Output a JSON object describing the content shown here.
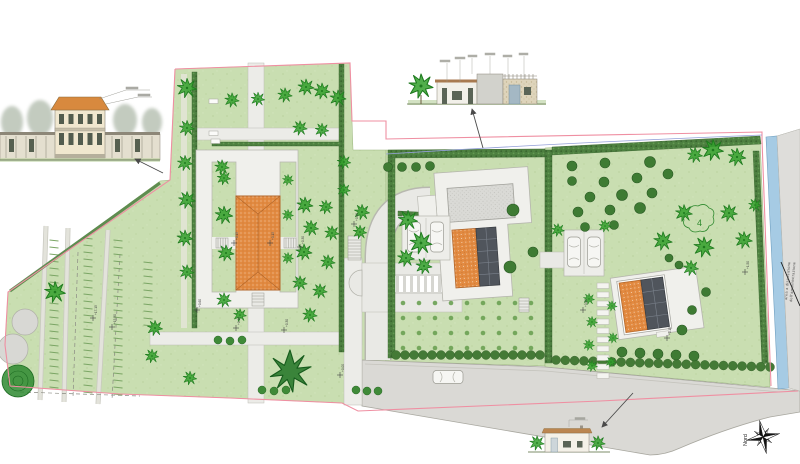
{
  "compass": {
    "north_label": "Nord"
  },
  "annotations": {
    "tree_count_label": "4",
    "road_note_line1": "area a disposizione",
    "road_note_line2": "dell'amministrazione"
  },
  "colors": {
    "lawn": "#c9deb1",
    "hedge": "#4d8040",
    "roof_orange": "#e28a41",
    "solar_panel": "#50555c",
    "canal_blue": "#a6cbe4",
    "boundary_pink": "#ef8fa2",
    "road_gray": "#dad9d5",
    "tree_green": "#33a02c"
  },
  "elevation_markers": [
    {
      "x": 93,
      "y": 318,
      "label": "+17.15"
    },
    {
      "x": 112,
      "y": 327,
      "label": "+15.50"
    },
    {
      "x": 234,
      "y": 243,
      "label": "+0.15"
    },
    {
      "x": 270,
      "y": 243,
      "label": "+0.15"
    },
    {
      "x": 300,
      "y": 247,
      "label": "+0.30"
    },
    {
      "x": 354,
      "y": 224,
      "label": "+0.45"
    },
    {
      "x": 197,
      "y": 310,
      "label": "+0.60"
    },
    {
      "x": 236,
      "y": 328,
      "label": "+0.15"
    },
    {
      "x": 284,
      "y": 330,
      "label": "+0.30"
    },
    {
      "x": 340,
      "y": 375,
      "label": "+0.00"
    },
    {
      "x": 583,
      "y": 310,
      "label": "+0.00"
    },
    {
      "x": 667,
      "y": 338,
      "label": "+0.15"
    },
    {
      "x": 745,
      "y": 272,
      "label": "+1.50"
    }
  ],
  "plan": {
    "trees_bright": [
      [
        187,
        88,
        1.2
      ],
      [
        232,
        100,
        0.9
      ],
      [
        258,
        99,
        0.85
      ],
      [
        285,
        95,
        0.9
      ],
      [
        306,
        87,
        1.0
      ],
      [
        322,
        91,
        1.0
      ],
      [
        338,
        98,
        1.0
      ],
      [
        300,
        128,
        0.9
      ],
      [
        322,
        130,
        0.85
      ],
      [
        187,
        128,
        0.95
      ],
      [
        185,
        163,
        0.95
      ],
      [
        187,
        200,
        1.05
      ],
      [
        185,
        238,
        1.0
      ],
      [
        187,
        272,
        0.9
      ],
      [
        222,
        167,
        0.9
      ],
      [
        224,
        178,
        0.85
      ],
      [
        224,
        215,
        1.1
      ],
      [
        226,
        253,
        1.0
      ],
      [
        224,
        300,
        0.9
      ],
      [
        288,
        180,
        0.7
      ],
      [
        288,
        215,
        0.7
      ],
      [
        288,
        258,
        0.7
      ],
      [
        305,
        205,
        1.0
      ],
      [
        311,
        228,
        0.95
      ],
      [
        304,
        252,
        1.0
      ],
      [
        300,
        283,
        0.9
      ],
      [
        326,
        207,
        0.85
      ],
      [
        332,
        233,
        0.9
      ],
      [
        328,
        262,
        0.9
      ],
      [
        320,
        291,
        0.9
      ],
      [
        344,
        162,
        0.85
      ],
      [
        344,
        190,
        0.8
      ],
      [
        310,
        315,
        0.9
      ],
      [
        240,
        315,
        0.8
      ],
      [
        362,
        212,
        0.95
      ],
      [
        360,
        232,
        0.85
      ],
      [
        408,
        220,
        1.2
      ],
      [
        421,
        243,
        1.35
      ],
      [
        406,
        258,
        1.05
      ],
      [
        424,
        266,
        1.0
      ],
      [
        55,
        292,
        1.3
      ],
      [
        155,
        328,
        0.95
      ],
      [
        152,
        356,
        0.85
      ],
      [
        190,
        378,
        0.85
      ],
      [
        589,
        299,
        0.7
      ],
      [
        592,
        322,
        0.7
      ],
      [
        589,
        345,
        0.7
      ],
      [
        592,
        366,
        0.7
      ],
      [
        612,
        306,
        0.65
      ],
      [
        613,
        338,
        0.65
      ],
      [
        611,
        362,
        0.65
      ],
      [
        558,
        230,
        0.8
      ],
      [
        605,
        226,
        0.75
      ],
      [
        713,
        150,
        1.3
      ],
      [
        737,
        157,
        1.1
      ],
      [
        695,
        155,
        0.95
      ],
      [
        684,
        213,
        1.05
      ],
      [
        729,
        213,
        1.05
      ],
      [
        663,
        241,
        1.15
      ],
      [
        704,
        247,
        1.25
      ],
      [
        744,
        240,
        1.05
      ],
      [
        691,
        268,
        0.95
      ],
      [
        755,
        205,
        0.8
      ]
    ],
    "trees_dark": [
      [
        572,
        166,
        5
      ],
      [
        605,
        163,
        5
      ],
      [
        650,
        162,
        5.5
      ],
      [
        668,
        174,
        5
      ],
      [
        572,
        181,
        4.5
      ],
      [
        604,
        182,
        5
      ],
      [
        637,
        178,
        5
      ],
      [
        590,
        197,
        5
      ],
      [
        622,
        195,
        5.5
      ],
      [
        652,
        193,
        5
      ],
      [
        578,
        212,
        5
      ],
      [
        610,
        210,
        5
      ],
      [
        640,
        208,
        5.5
      ],
      [
        585,
        227,
        4.5
      ],
      [
        614,
        225,
        4.5
      ],
      [
        669,
        258,
        4
      ],
      [
        679,
        265,
        4
      ],
      [
        682,
        330,
        5
      ],
      [
        706,
        292,
        4.5
      ],
      [
        692,
        310,
        4.5
      ],
      [
        510,
        267,
        6
      ],
      [
        513,
        210,
        6
      ],
      [
        533,
        252,
        5
      ],
      [
        388,
        167,
        4.5
      ],
      [
        402,
        167,
        4.5
      ],
      [
        416,
        167,
        4.5
      ],
      [
        430,
        166,
        4.5
      ],
      [
        622,
        352,
        5
      ],
      [
        640,
        353,
        5
      ],
      [
        658,
        354,
        5
      ],
      [
        676,
        355,
        5
      ],
      [
        694,
        356,
        5
      ]
    ],
    "shrubs": [
      [
        218,
        340
      ],
      [
        230,
        341
      ],
      [
        242,
        340
      ],
      [
        262,
        390
      ],
      [
        274,
        391
      ],
      [
        286,
        390
      ],
      [
        356,
        390
      ],
      [
        367,
        391
      ],
      [
        378,
        391
      ]
    ],
    "stepping_stones": {
      "x": 597,
      "y0": 283,
      "step": 9,
      "count": 11,
      "w": 12,
      "h": 5.5
    },
    "orchard_grid": {
      "x0": 403,
      "y0": 303,
      "cols": 9,
      "rows": 4,
      "dx": 16,
      "dy": 15,
      "r": 2.3
    },
    "scallop_rows": [
      {
        "x1": 396,
        "y1": 355,
        "x2": 540,
        "y2": 355,
        "step": 9,
        "r": 4.5
      },
      {
        "x1": 556,
        "y1": 360,
        "x2": 770,
        "y2": 367,
        "step": 9,
        "r": 4.5
      }
    ],
    "tick_columns": [
      {
        "x": 54,
        "y0": 240,
        "y1": 392,
        "step": 7,
        "len": 9
      },
      {
        "x": 88,
        "y0": 238,
        "y1": 396,
        "step": 7,
        "len": 9
      },
      {
        "x": 118,
        "y0": 240,
        "y1": 398,
        "step": 7,
        "len": 9
      },
      {
        "x": 148,
        "y0": 262,
        "y1": 330,
        "step": 7,
        "len": 9
      }
    ]
  }
}
